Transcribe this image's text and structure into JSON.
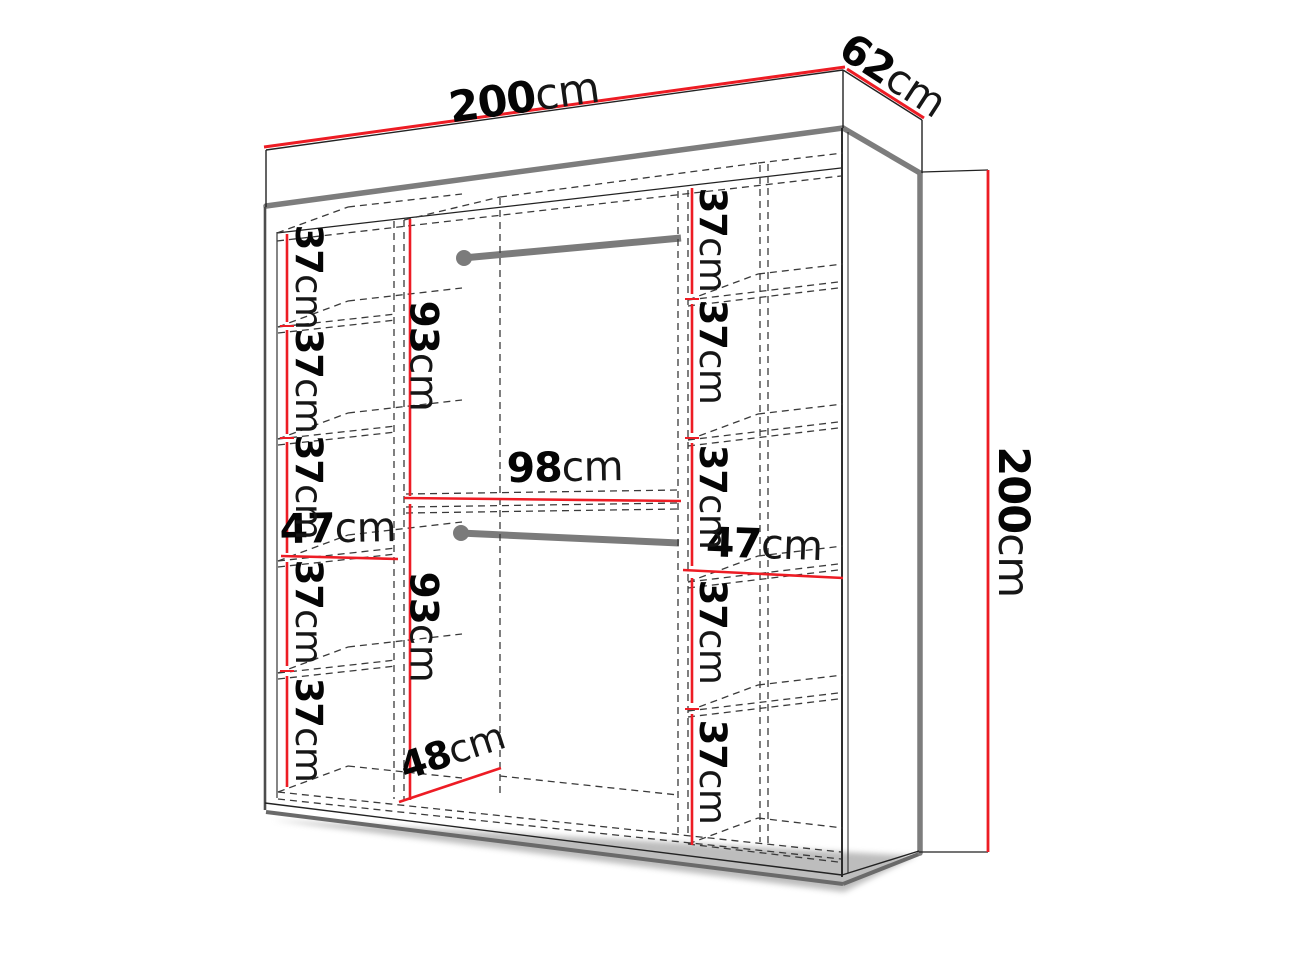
{
  "diagram": {
    "name": "wardrobe-dimensions-diagram",
    "colors": {
      "dimension_red": "#ed1c24",
      "edge_gray": "#7d7d7d",
      "line_black": "#1c1c1c",
      "shadow_gray": "#8f8f8f",
      "background": "#ffffff"
    },
    "dimensions": {
      "top_width": {
        "num": "200",
        "unit": "cm"
      },
      "top_depth": {
        "num": "62",
        "unit": "cm"
      },
      "right_height": {
        "num": "200",
        "unit": "cm"
      },
      "middle_width": {
        "num": "98",
        "unit": "cm"
      },
      "hang_upper": {
        "num": "93",
        "unit": "cm"
      },
      "hang_lower": {
        "num": "93",
        "unit": "cm"
      },
      "left_col_width": {
        "num": "47",
        "unit": "cm"
      },
      "right_col_width": {
        "num": "47",
        "unit": "cm"
      },
      "interior_depth": {
        "num": "48",
        "unit": "cm"
      },
      "left_shelves": [
        {
          "num": "37",
          "unit": "cm"
        },
        {
          "num": "37",
          "unit": "cm"
        },
        {
          "num": "37",
          "unit": "cm"
        },
        {
          "num": "37",
          "unit": "cm"
        },
        {
          "num": "37",
          "unit": "cm"
        }
      ],
      "right_shelves": [
        {
          "num": "37",
          "unit": "cm"
        },
        {
          "num": "37",
          "unit": "cm"
        },
        {
          "num": "37",
          "unit": "cm"
        },
        {
          "num": "37",
          "unit": "cm"
        },
        {
          "num": "37",
          "unit": "cm"
        }
      ]
    }
  }
}
